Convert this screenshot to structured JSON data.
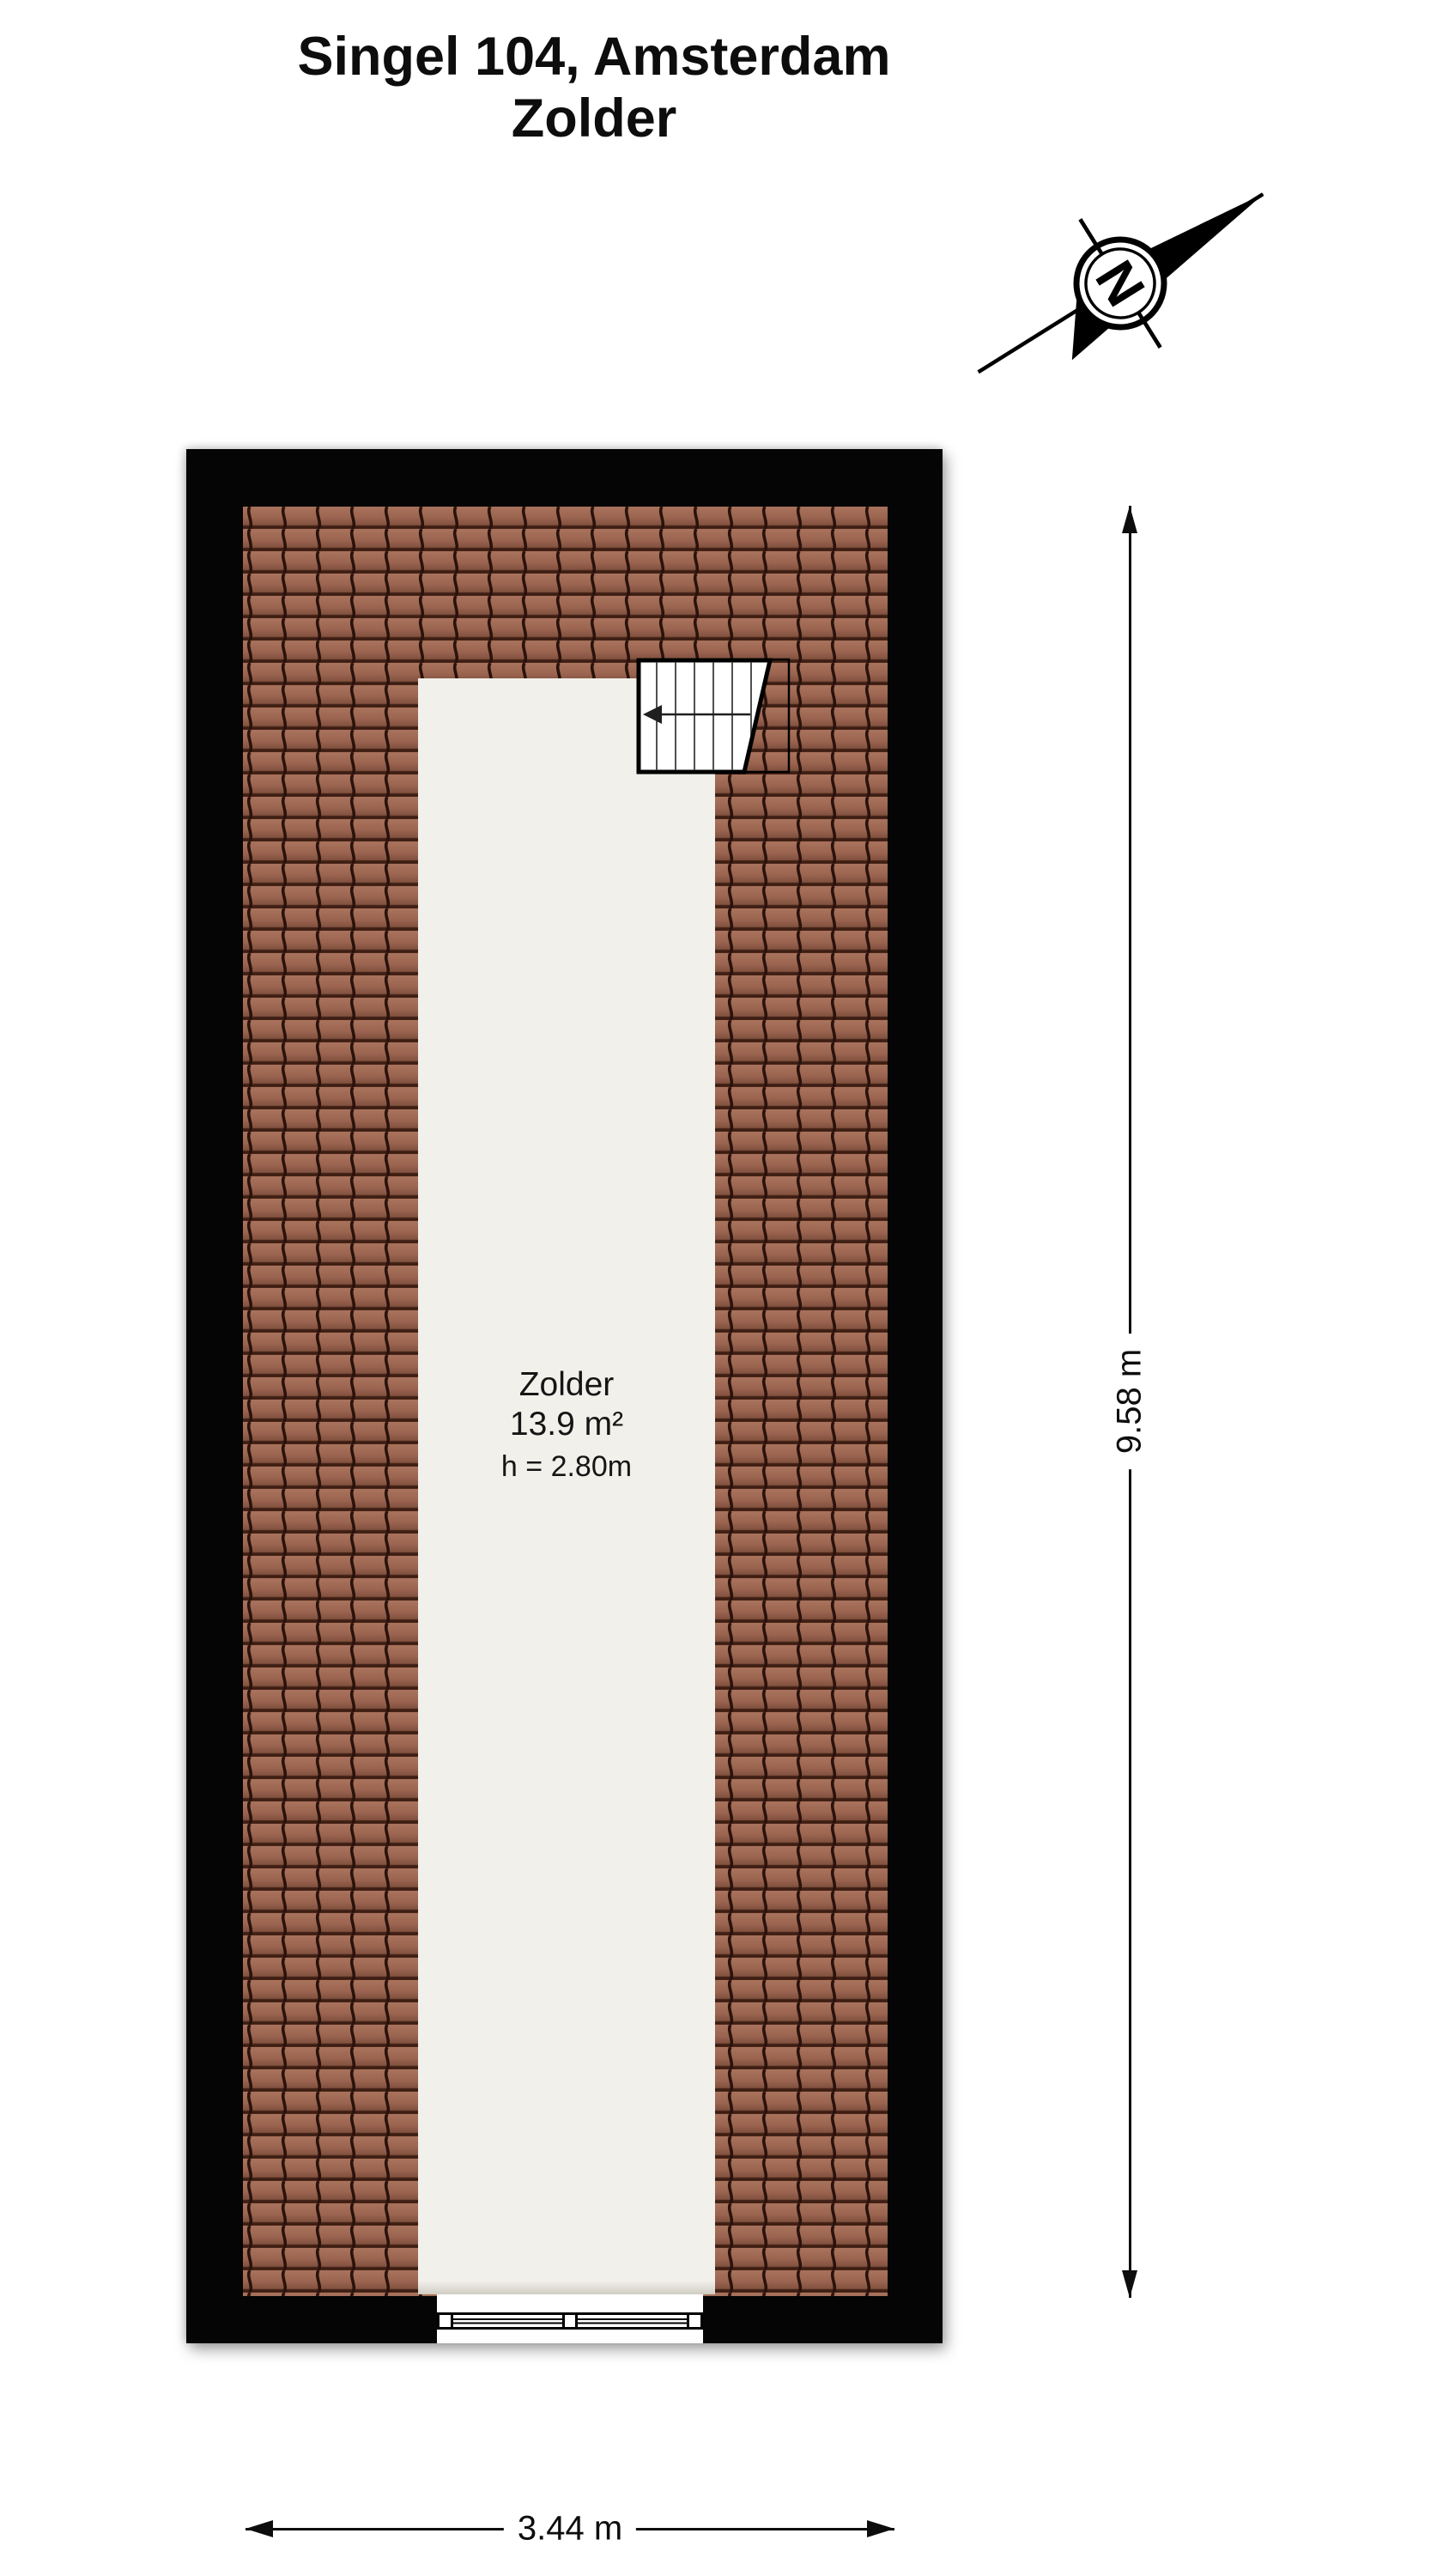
{
  "title": {
    "line1": "Singel 104, Amsterdam",
    "line2": "Zolder"
  },
  "compass": {
    "label": "N"
  },
  "room": {
    "name": "Zolder",
    "area": "13.9 m²",
    "ceiling_height": "h = 2.80m"
  },
  "dimensions": {
    "height": "9.58 m",
    "width": "3.44 m"
  },
  "colors": {
    "wall": "#050505",
    "roof_tile_base": "#9a6450",
    "roof_tile_groove": "#2a120b",
    "roof_tile_row_line": "#3a1a0f",
    "room_fill": "#f1f0ea",
    "window_fill": "#ffffff",
    "ink": "#0d0d0d"
  }
}
